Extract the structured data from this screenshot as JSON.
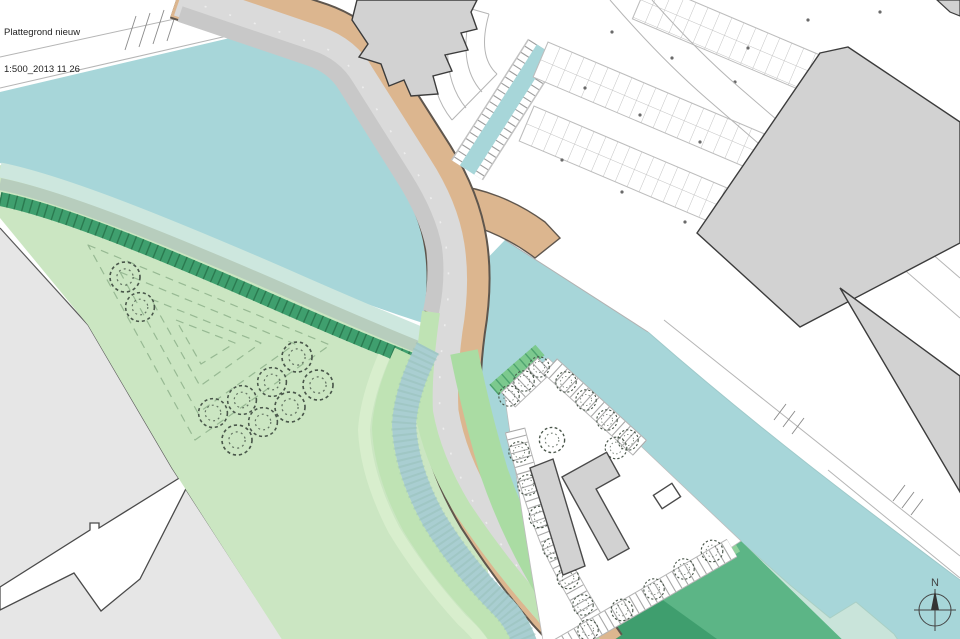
{
  "title_block": {
    "line1": "Plattegrond nieuw",
    "line2": "1:500_2013 11 26"
  },
  "compass": {
    "label": "N"
  },
  "colors": {
    "water": "#a7d6d9",
    "shallow": "#c9e4da",
    "ditch": "#a9ced1",
    "grass": "#cbe6c2",
    "grassBright": "#aadca3",
    "strip": "#bfe3b4",
    "paleOuter": "#d8eecd",
    "lawn": "#5cb586",
    "lawnDark": "#3f9e6e",
    "embank": "#3f9f6e",
    "embankTick": "#2b7a50",
    "bandPale": "#cde7de",
    "bandGray": "#b7cdbd",
    "midband": "#a9d2b8",
    "road": "#dadada",
    "roadCasing": "#5f564d",
    "tan": "#dcb68f",
    "quay": "#c8c8c8",
    "land": "#e6e6e6",
    "landLine": "#5a5a5a",
    "building": "#d2d2d2",
    "buildingStroke": "#3c3c3c",
    "thinLine": "#b5b5b5",
    "tick": "#a8a8a8",
    "tree": "#49564a",
    "contour": "#97b993",
    "shoreLine": "#9fc9ca",
    "text": "#222222",
    "compassColor": "#444444"
  }
}
